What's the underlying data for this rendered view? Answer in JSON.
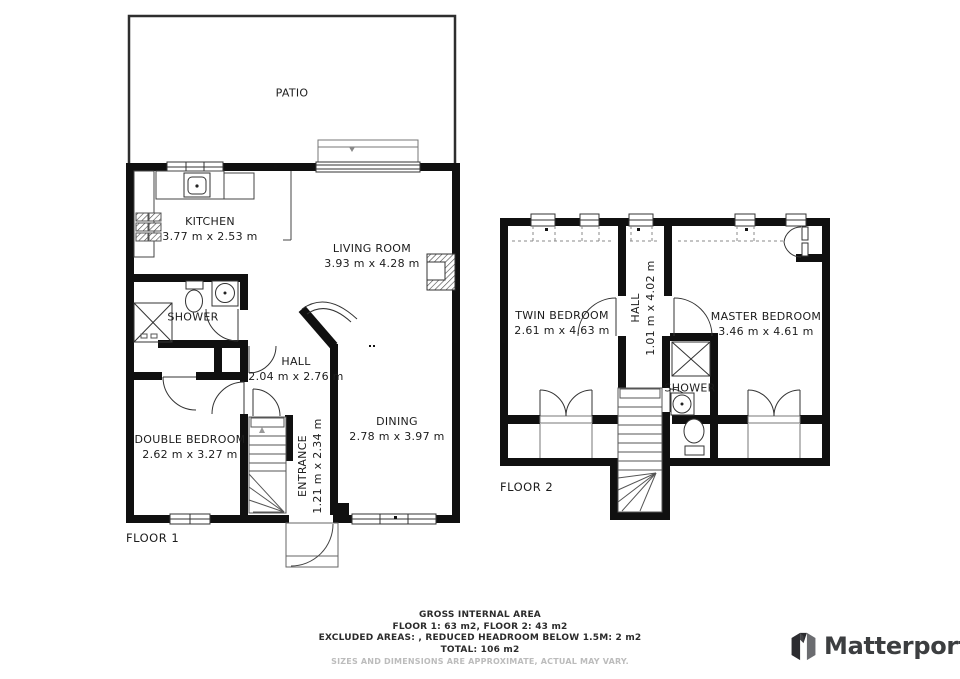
{
  "colors": {
    "wall": "#101010",
    "thin_line": "#555555",
    "text": "#1c1c1c",
    "muted": "#bcbcbc",
    "logo": "#3c3e40"
  },
  "floor1": {
    "label": "FLOOR 1",
    "rooms": {
      "patio": {
        "name": "PATIO"
      },
      "kitchen": {
        "name": "KITCHEN",
        "dims": "3.77 m x 2.53 m"
      },
      "living_room": {
        "name": "LIVING ROOM",
        "dims": "3.93 m x 4.28 m"
      },
      "shower": {
        "name": "SHOWER"
      },
      "hall": {
        "name": "HALL",
        "dims": "2.04 m x 2.76 m"
      },
      "double_bedroom": {
        "name": "DOUBLE BEDROOM",
        "dims": "2.62 m x 3.27 m"
      },
      "entrance": {
        "name": "ENTRANCE",
        "dims": "1.21 m x 2.34 m"
      },
      "dining": {
        "name": "DINING",
        "dims": "2.78 m x 3.97 m"
      }
    }
  },
  "floor2": {
    "label": "FLOOR 2",
    "rooms": {
      "twin_bedroom": {
        "name": "TWIN BEDROOM",
        "dims": "2.61 m x 4.63 m"
      },
      "hall": {
        "name": "HALL",
        "dims": "1.01 m x 4.02 m"
      },
      "master_bedroom": {
        "name": "MASTER BEDROOM",
        "dims": "3.46 m x 4.61 m"
      },
      "shower": {
        "name": "SHOWER"
      }
    }
  },
  "footer": {
    "title": "GROSS INTERNAL AREA",
    "floors": "FLOOR 1: 63 m2, FLOOR 2: 43 m2",
    "excluded": "EXCLUDED AREAS: , REDUCED HEADROOM BELOW 1.5M: 2 m2",
    "total": "TOTAL: 106 m2",
    "disclaimer": "SIZES AND DIMENSIONS ARE APPROXIMATE, ACTUAL MAY VARY."
  },
  "branding": {
    "name": "Matterport"
  }
}
